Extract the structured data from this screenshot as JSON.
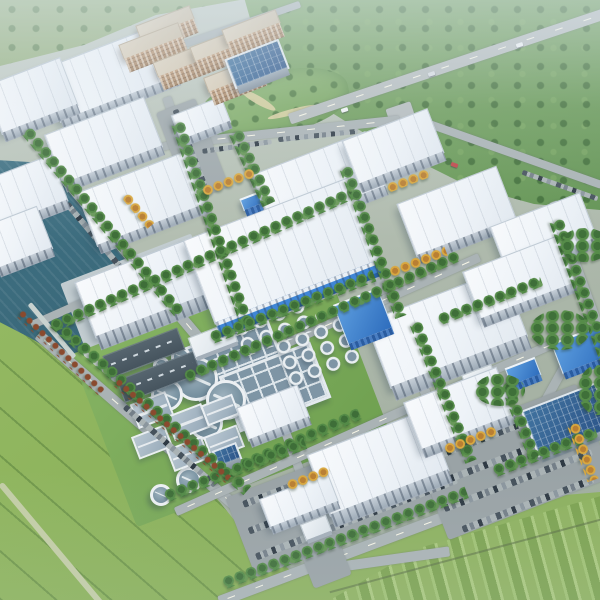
{
  "scene": {
    "description": "Aerial bird's-eye 3D architectural rendering of an industrial business park: rows of white flat-roof logistics warehouses, tan dormitory blocks, a wastewater treatment plant with circular clarifier tanks and gridded basins, a teal river with a quay inlet on the left, internal roads with parked cars, large parking lots, a forest greenbelt crossed by a highway at top right, open meadow at lower left and striped farmland at lower right",
    "view": "isometric aerial, rows oriented diagonally toward upper right",
    "visible_text": ""
  },
  "palette": {
    "haze_sky": "#dfe8ee",
    "ground": "#aeb9ac",
    "roof_white": "#f3f7fa",
    "facade_gray": "#aeb9c4",
    "glass_blue": "#2e6dbd",
    "solar_panel_blue": "#35639f",
    "accent_band_blue": "#3f86d6",
    "residential_tan": "#cdbfa8",
    "water_teal": "#3a6c7e",
    "tank_gray_blue": "#7e95a5",
    "tank_rim_white": "#ecf0f3",
    "lawn_green": "#7cab5a",
    "forest_green": "#5f9150",
    "meadow_green": "#8fb55e",
    "road_gray": "#aab3b5",
    "autumn_yellow": "#d9a83f",
    "hedge_red": "#8a4a2e"
  },
  "features": {
    "white_warehouses": 16,
    "dormitory_blocks": 6,
    "solar_roof_buildings": 2,
    "blue_glass_buildings": 4,
    "large_clarifier_tanks": 4,
    "small_clarifier_tanks": 4,
    "small_tank_grid_clusters": 2,
    "gridded_settling_basins": 2,
    "covered_basins": 6,
    "dark_roof_halls": 2,
    "parking_lots": 4,
    "roads": [
      "highway through forest",
      "branch road",
      "riverside road",
      "perimeter road",
      "internal row streets",
      "cross streets"
    ],
    "water_bodies": [
      "river",
      "rectangular quay inlet"
    ]
  }
}
